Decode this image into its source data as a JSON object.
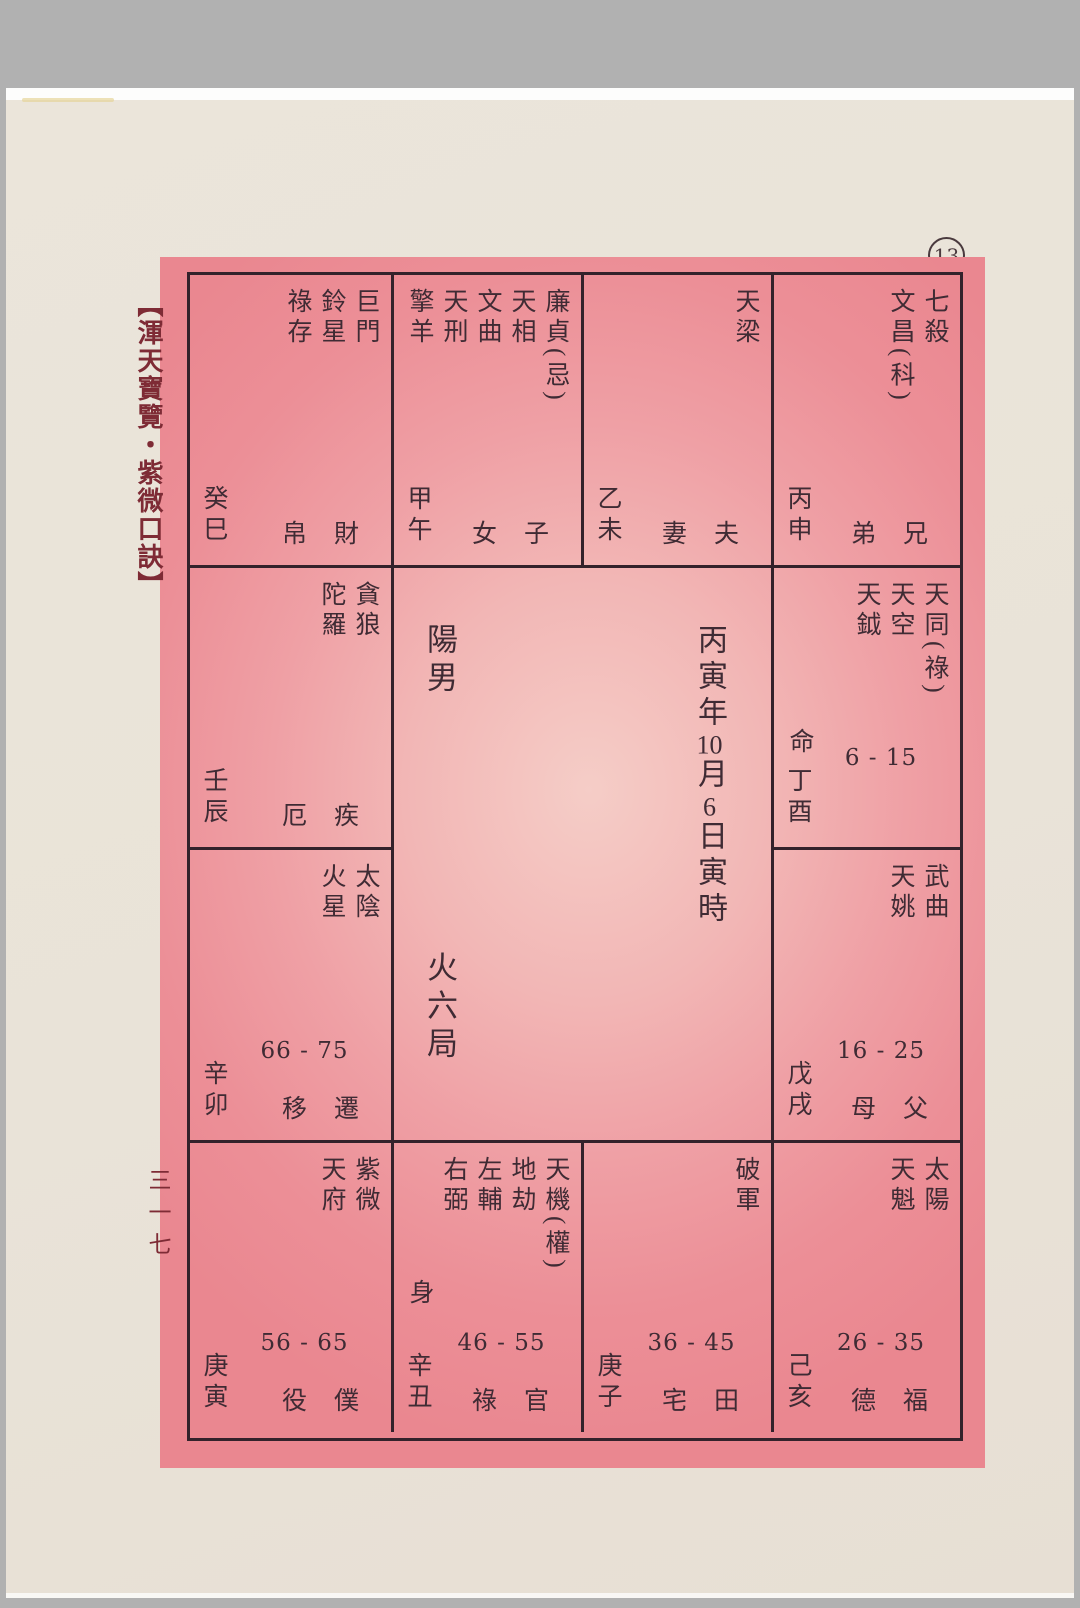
{
  "page": {
    "circled_number": "13",
    "side_title": "【渾天寶覽・紫微口訣】",
    "folio": "三一七"
  },
  "center": {
    "gender": "陽男",
    "bureau": "火六局",
    "birth": [
      "丙寅年",
      "10",
      "月",
      "6",
      "日寅時"
    ]
  },
  "colors": {
    "pink": "#ec8f97",
    "paper": "#e9e3d8",
    "frame_grey": "#b1b1b1",
    "line": "#33222b",
    "ink": "#3f2b34",
    "title_red": "#7e2b35"
  },
  "palaces": [
    {
      "id": "si",
      "stars": [
        "巨門",
        "鈴星",
        "祿存"
      ],
      "branch": "癸巳",
      "palace": [
        "財",
        "帛"
      ],
      "range": "",
      "marker": ""
    },
    {
      "id": "wu",
      "stars": [
        "廉貞(忌)",
        "天相",
        "文曲",
        "天刑",
        "擎羊"
      ],
      "branch": "甲午",
      "palace": [
        "子",
        "女"
      ],
      "range": "",
      "marker": ""
    },
    {
      "id": "wei",
      "stars": [
        "天梁"
      ],
      "branch": "乙未",
      "palace": [
        "夫",
        "妻"
      ],
      "range": "",
      "marker": ""
    },
    {
      "id": "shen",
      "stars": [
        "七殺",
        "文昌(科)"
      ],
      "branch": "丙申",
      "palace": [
        "兄",
        "弟"
      ],
      "range": "",
      "marker": ""
    },
    {
      "id": "chen",
      "stars": [
        "貪狼",
        "陀羅"
      ],
      "branch": "壬辰",
      "palace": [
        "疾",
        "厄"
      ],
      "range": "",
      "marker": ""
    },
    {
      "id": "you",
      "stars": [
        "天同(祿)",
        "天空",
        "天鉞"
      ],
      "branch": "丁酉",
      "palace": [],
      "range": "6 - 15",
      "marker": "命"
    },
    {
      "id": "mao",
      "stars": [
        "太陰",
        "火星"
      ],
      "branch": "辛卯",
      "palace": [
        "遷",
        "移"
      ],
      "range": "66 - 75",
      "marker": ""
    },
    {
      "id": "xu",
      "stars": [
        "武曲",
        "天姚"
      ],
      "branch": "戊戌",
      "palace": [
        "父",
        "母"
      ],
      "range": "16 - 25",
      "marker": ""
    },
    {
      "id": "yin",
      "stars": [
        "紫微",
        "天府"
      ],
      "branch": "庚寅",
      "palace": [
        "僕",
        "役"
      ],
      "range": "56 - 65",
      "marker": ""
    },
    {
      "id": "chou",
      "stars": [
        "天機(權)",
        "地劫",
        "左輔",
        "右弼"
      ],
      "branch": "辛丑",
      "palace": [
        "官",
        "祿"
      ],
      "range": "46 - 55",
      "marker": "身"
    },
    {
      "id": "zi",
      "stars": [
        "破軍"
      ],
      "branch": "庚子",
      "palace": [
        "田",
        "宅"
      ],
      "range": "36 - 45",
      "marker": ""
    },
    {
      "id": "hai",
      "stars": [
        "太陽",
        "天魁"
      ],
      "branch": "己亥",
      "palace": [
        "福",
        "德"
      ],
      "range": "26 - 35",
      "marker": ""
    }
  ]
}
